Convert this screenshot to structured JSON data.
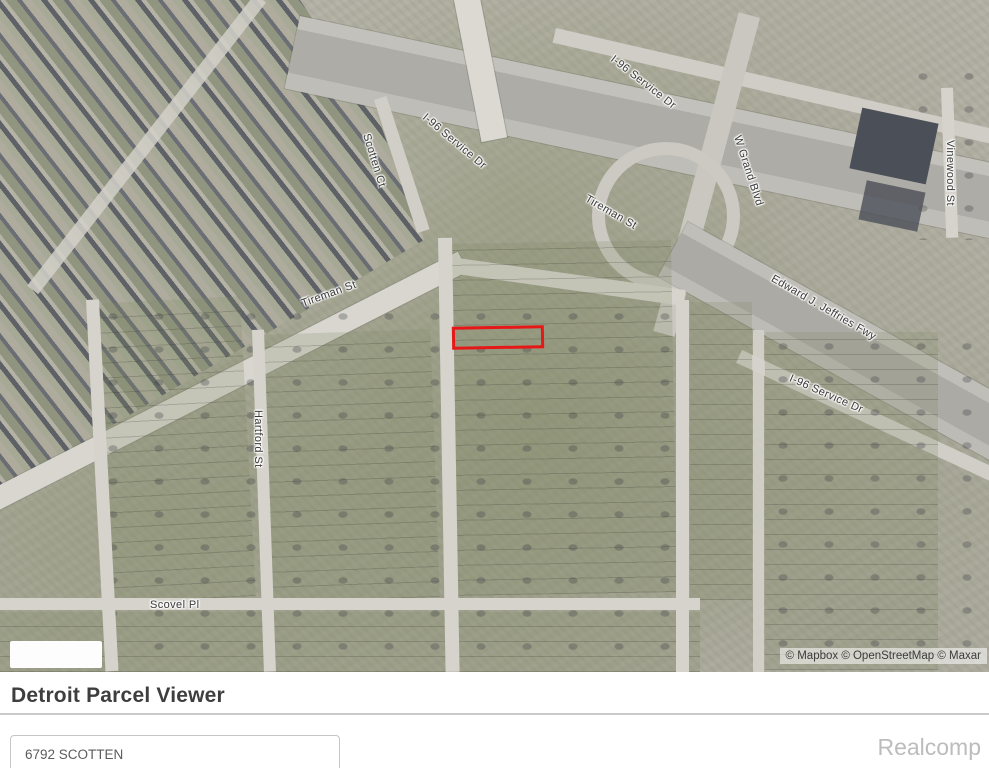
{
  "map": {
    "attribution": "© Mapbox © OpenStreetMap © Maxar",
    "highlight_color": "#e51717",
    "labels": [
      {
        "text": "I-96 Service Dr"
      },
      {
        "text": "Scotten Ct"
      },
      {
        "text": "I-96 Service Dr"
      },
      {
        "text": "Tireman St"
      },
      {
        "text": "W Grand Blvd"
      },
      {
        "text": "Vinewood St"
      },
      {
        "text": "Edward J. Jeffries Fwy"
      },
      {
        "text": "I-96 Service Dr"
      },
      {
        "text": "Tireman St"
      },
      {
        "text": "Hartford St"
      },
      {
        "text": "Scovel Pl"
      }
    ]
  },
  "panel": {
    "title": "Detroit Parcel Viewer",
    "search_input": {
      "value": "6792 SCOTTEN"
    },
    "watermark": "Realcomp"
  }
}
